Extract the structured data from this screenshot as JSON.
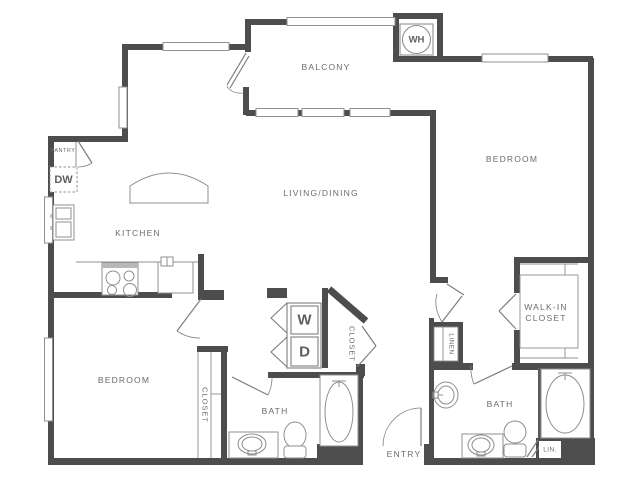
{
  "colors": {
    "wall": "#4d4d4d",
    "fixture_line": "#8f8f8f",
    "label_text": "#6b6b6b",
    "background": "#ffffff"
  },
  "rooms": {
    "balcony": "BALCONY",
    "living_dining": "LIVING/DINING",
    "kitchen": "KITCHEN",
    "bedroom_right": "BEDROOM",
    "bedroom_left": "BEDROOM",
    "bath_left": "BATH",
    "bath_right": "BATH",
    "entry": "ENTRY",
    "walk_in_closet_line1": "WALK-IN",
    "walk_in_closet_line2": "CLOSET",
    "closet_bedroom_left": "CLOSET",
    "closet_hall": "CLOSET",
    "pantry": "PANTRY",
    "linen": "LINEN",
    "linen_small": "LIN."
  },
  "appliances": {
    "dishwasher": "DW",
    "water_heater": "WH",
    "washer": "W",
    "dryer": "D"
  }
}
